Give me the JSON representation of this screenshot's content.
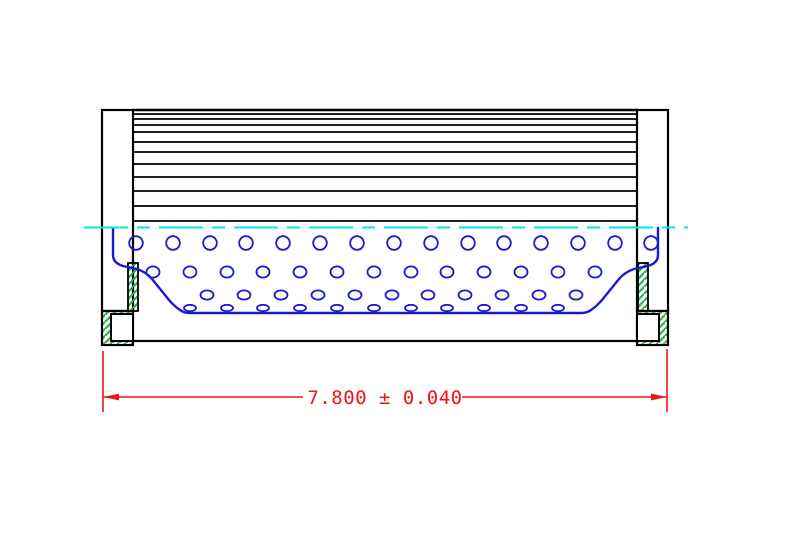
{
  "drawing": {
    "type": "technical-section-drawing",
    "subject": "cylindrical-filter-element-side-section",
    "background": "#ffffff",
    "colors": {
      "outline": "#000000",
      "core": "#1a1ad0",
      "centerline": "#00e6ee",
      "hatch": "#2db34a",
      "dimension": "#f21414"
    },
    "dimension": {
      "label": "7.800 ± 0.040",
      "value": "7.800",
      "tolerance": "0.040"
    },
    "geometry": {
      "canvas": {
        "w": 789,
        "h": 546
      },
      "caps": {
        "left": {
          "x": 102,
          "y": 110,
          "w": 31,
          "h": 201
        },
        "right": {
          "x": 637,
          "y": 110,
          "w": 31,
          "h": 201
        }
      },
      "bosses": {
        "left": {
          "outer": {
            "x": 102,
            "y": 311,
            "w": 31,
            "h": 34
          },
          "inner": {
            "x": 111,
            "y": 314,
            "w": 22,
            "h": 27
          }
        },
        "right": {
          "outer": {
            "x": 637,
            "y": 311,
            "w": 31,
            "h": 34
          },
          "inner": {
            "x": 637,
            "y": 314,
            "w": 22,
            "h": 27
          }
        }
      },
      "hatch_strips": [
        {
          "x": 128,
          "y": 263,
          "w": 10,
          "h": 48
        },
        {
          "x": 638,
          "y": 263,
          "w": 10,
          "h": 48
        }
      ],
      "pleats": {
        "x1": 133,
        "x2": 638,
        "ys": [
          110,
          114,
          119,
          125,
          132,
          142,
          152,
          164,
          177,
          191,
          206,
          221
        ]
      },
      "bottom_edge": {
        "x1": 133,
        "x2": 638,
        "y": 341
      },
      "centerline": {
        "x1": 84,
        "x2": 688,
        "y": 227.5,
        "dash": "44 9 13 9"
      },
      "core": {
        "path": "M 113 228 L 113 255 Q 113 263 123 266 L 137 269 Q 146 272 152 279 L 169 300 Q 174 306 180 310 Q 184 313 190 313 L 581 313 Q 587 313 591 310 Q 597 306 602 300 L 619 279 Q 625 272 634 269 L 648 266 Q 658 263 658 255 L 658 228",
        "holes": [
          {
            "y": 243,
            "rx": 6.8,
            "ry": 6.8,
            "xs": [
              136,
              173,
              210,
              246,
              283,
              320,
              357,
              394,
              431,
              468,
              504,
              541,
              578,
              615,
              651
            ]
          },
          {
            "y": 272,
            "rx": 6.5,
            "ry": 5.6,
            "xs": [
              153,
              190,
              227,
              263,
              300,
              337,
              374,
              411,
              447,
              484,
              521,
              558,
              595
            ]
          },
          {
            "y": 295,
            "rx": 6.5,
            "ry": 4.6,
            "xs": [
              207,
              244,
              281,
              318,
              355,
              392,
              428,
              465,
              502,
              539,
              576
            ]
          },
          {
            "y": 308,
            "rx": 6.0,
            "ry": 3.2,
            "xs": [
              190,
              227,
              263,
              300,
              337,
              374,
              411,
              447,
              484,
              521,
              558
            ]
          }
        ]
      },
      "dimension": {
        "ext_left": {
          "x": 103,
          "y1": 351,
          "y2": 412
        },
        "ext_right": {
          "x": 667,
          "y1": 349,
          "y2": 412
        },
        "line": {
          "y": 397,
          "x1": 103,
          "x2": 667,
          "gap_x1": 303,
          "gap_x2": 462
        },
        "arrow_len": 16,
        "arrow_half": 3.4,
        "text": {
          "x": 385,
          "y": 404
        }
      }
    }
  }
}
